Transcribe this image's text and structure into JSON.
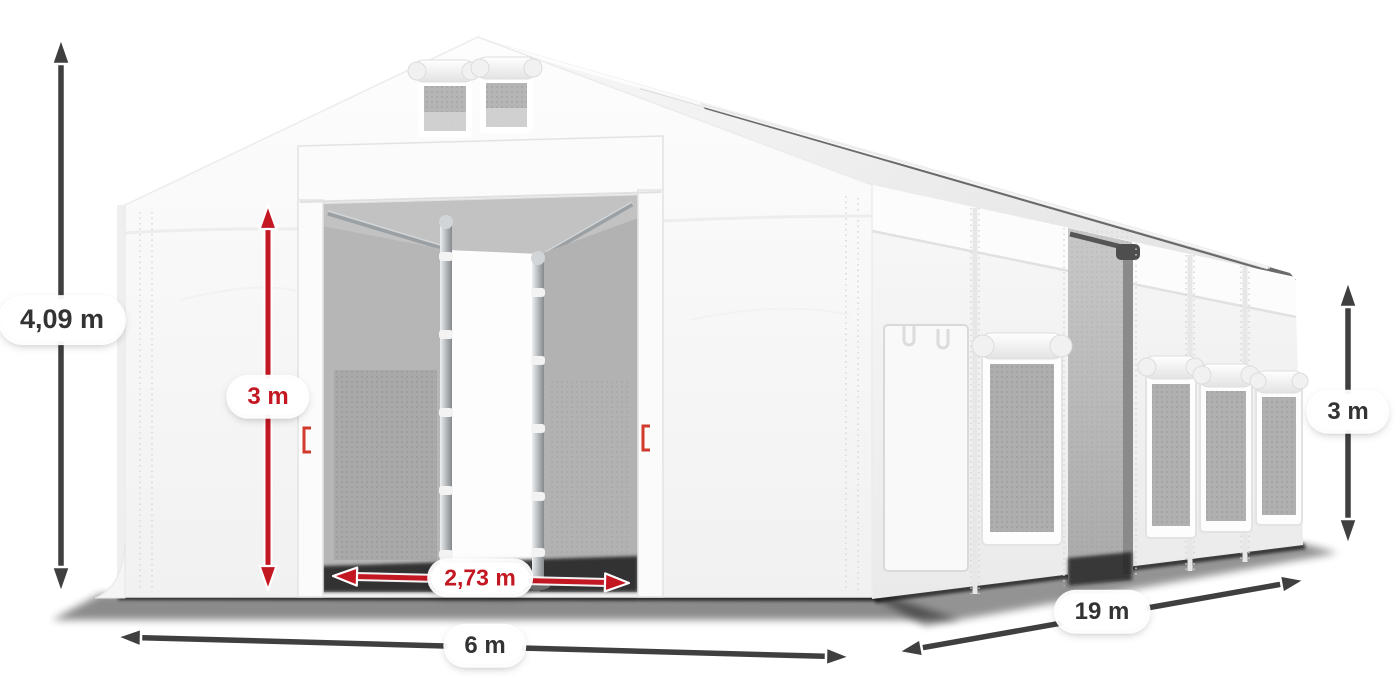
{
  "diagram": {
    "type": "product-dimension-diagram",
    "subject": "white storage marquee tent, three-quarter view with open front entrance",
    "colors": {
      "dimension_red": "#c31722",
      "dimension_dark": "#3f3f3f",
      "tent_white": "#f7f7f7",
      "interior_gray": "#b4b4b4"
    },
    "labels": {
      "total_height": "4,09 m",
      "entrance_height": "3 m",
      "entrance_width": "2,73 m",
      "front_width": "6 m",
      "side_length": "19 m",
      "side_wall_height": "3 m"
    }
  }
}
